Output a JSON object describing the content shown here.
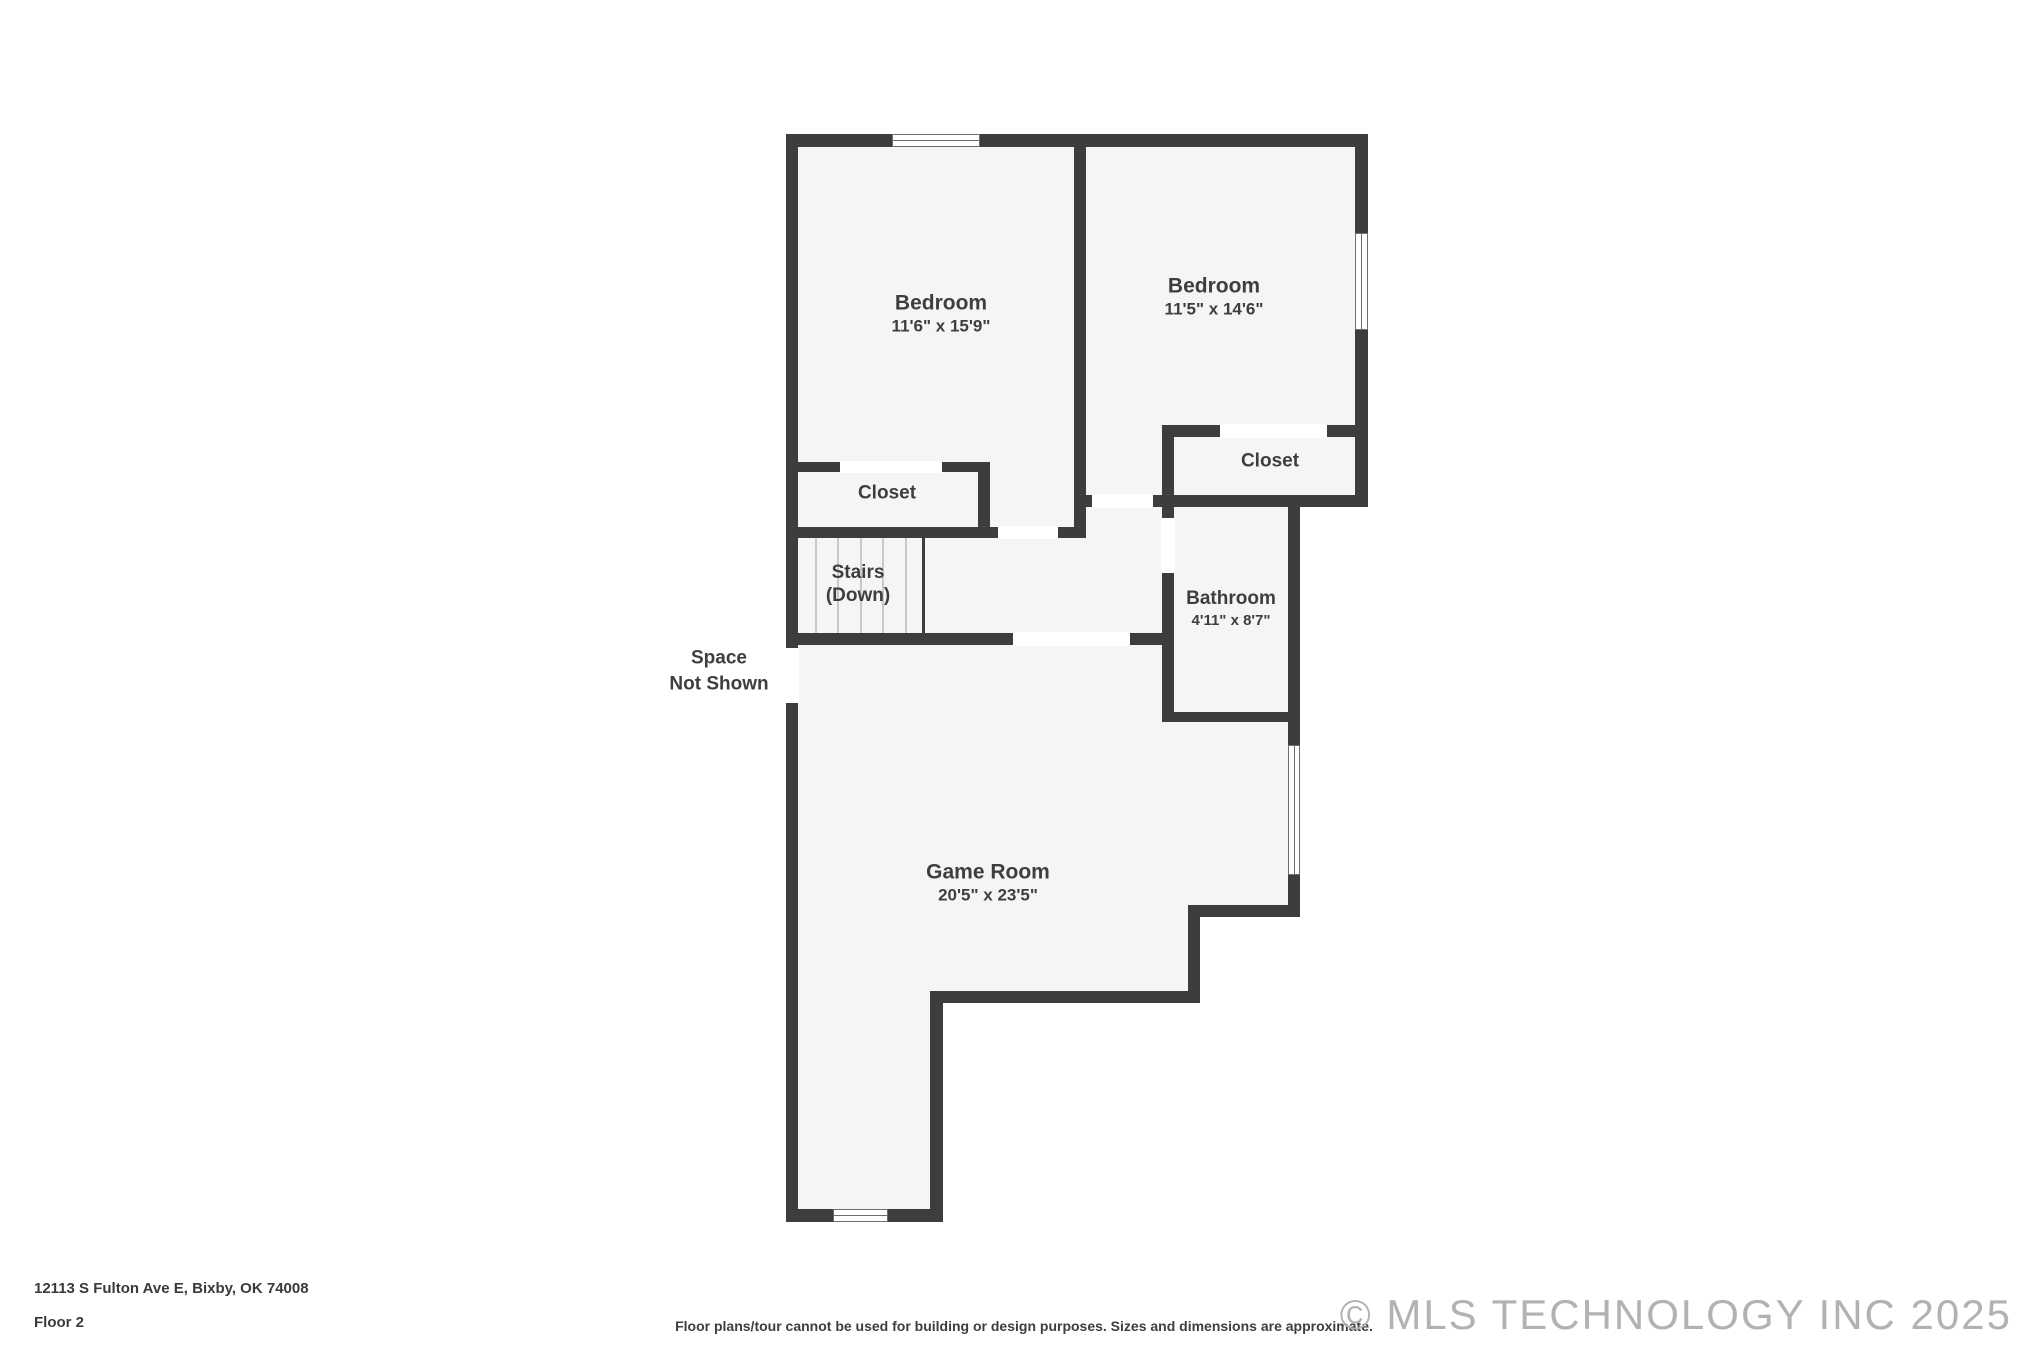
{
  "theme": {
    "wall_color": "#3d3d3d",
    "floor_color": "#f5f5f6",
    "label_color": "#3e3e3e",
    "tread_color": "#c9c9c9",
    "watermark_color": "#b2b2b2",
    "background_color": "#ffffff"
  },
  "rooms": {
    "bedroom_left": {
      "name": "Bedroom",
      "dims": "11'6\" x 15'9\""
    },
    "bedroom_right": {
      "name": "Bedroom",
      "dims": "11'5\" x 14'6\""
    },
    "closet_left": {
      "name": "Closet"
    },
    "closet_right": {
      "name": "Closet"
    },
    "stairs": {
      "name": "Stairs",
      "qualifier": "(Down)"
    },
    "bathroom": {
      "name": "Bathroom",
      "dims": "4'11\" x 8'7\""
    },
    "game_room": {
      "name": "Game Room",
      "dims": "20'5\" x 23'5\""
    },
    "space_not_shown": {
      "line1": "Space",
      "line2": "Not Shown"
    }
  },
  "footer": {
    "address": "12113 S Fulton Ave E, Bixby, OK 74008",
    "floor_label": "Floor 2",
    "disclaimer": "Floor plans/tour cannot be used for building or design purposes. Sizes and dimensions are approximate.",
    "watermark": "© MLS TECHNOLOGY INC 2025"
  }
}
